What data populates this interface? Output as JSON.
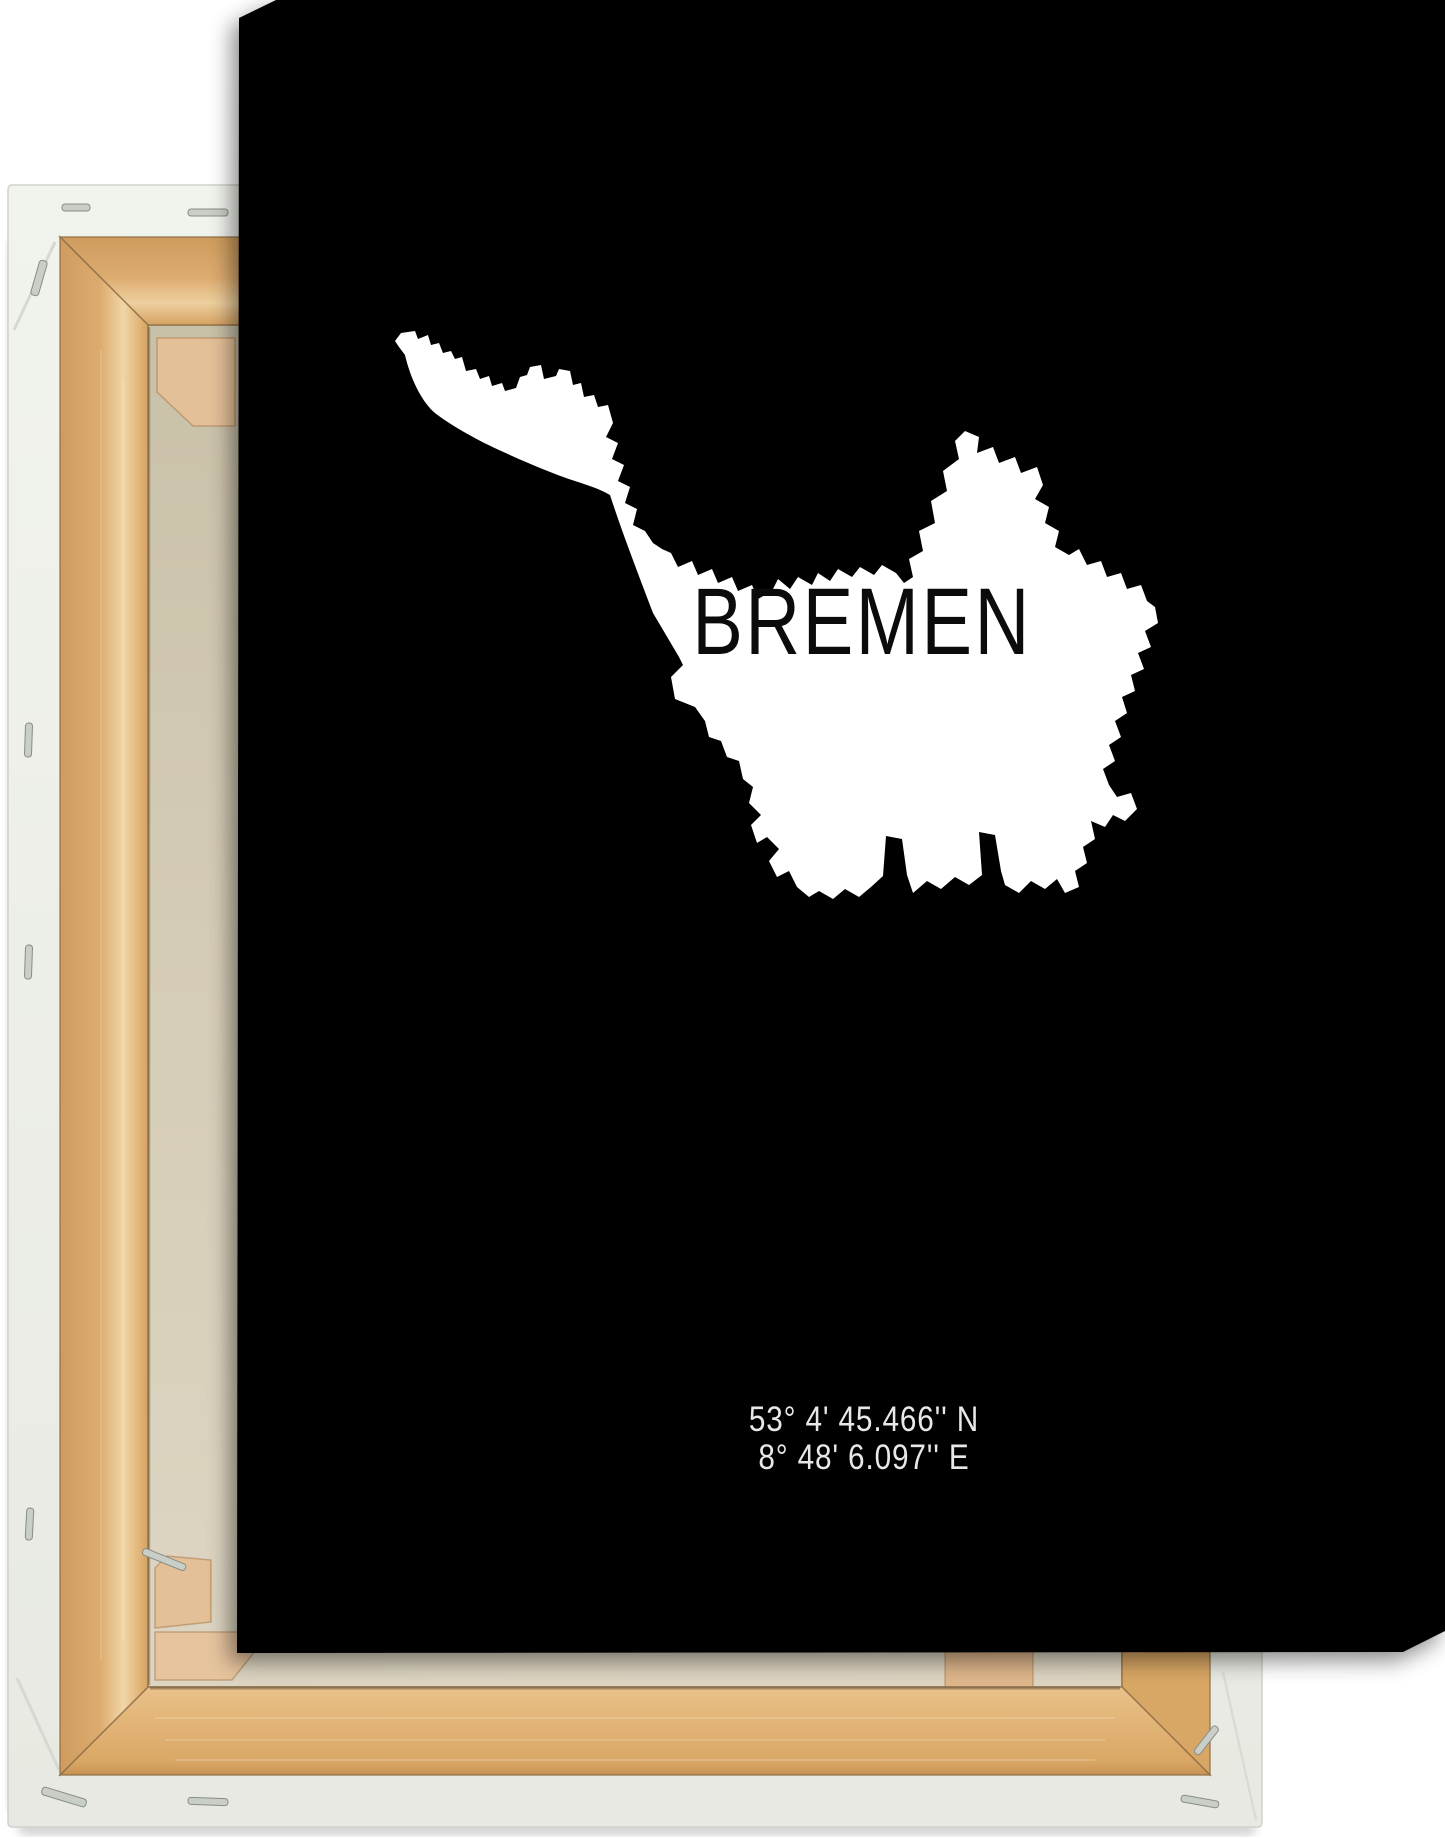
{
  "poster": {
    "title": "BREMEN",
    "coordinates": {
      "line1": "53° 4' 45.466'' N",
      "line2": "8° 48' 6.097'' E"
    },
    "colors": {
      "background": "#000000",
      "map_fill": "#ffffff",
      "title": "#0b0b0b",
      "coordinates": "#e8e8e8"
    },
    "map_path": "M 30 14 L 36 6 L 50 4 L 53 12 L 63 8 L 66 18 L 74 16 L 78 26 L 86 24 L 90 32 L 97 30 L 101 44 L 111 42 L 115 52 L 124 49 L 127 59 L 137 56 L 140 64 L 151 61 L 155 50 L 162 48 L 165 40 L 176 38 L 179 52 L 191 49 L 194 42 L 205 44 L 208 58 L 216 56 L 219 70 L 229 68 L 233 80 L 243 78 L 248 96 L 241 110 L 253 116 L 247 132 L 259 138 L 253 154 L 265 160 L 260 176 L 272 182 L 268 198 L 280 204 L 288 216 L 297 222 L 306 226 L 313 240 L 327 234 L 333 248 L 347 242 L 353 256 L 367 250 L 373 264 L 387 258 L 393 272 L 407 264 L 413 252 L 425 262 L 433 250 L 447 258 L 453 246 L 465 254 L 473 242 L 487 250 L 495 240 L 509 248 L 517 238 L 531 246 L 539 256 L 548 250 L 544 232 L 558 224 L 554 204 L 570 196 L 566 174 L 582 164 L 578 144 L 594 132 L 590 114 L 600 104 L 614 110 L 612 126 L 628 120 L 634 136 L 650 130 L 656 146 L 672 140 L 678 158 L 670 172 L 684 180 L 680 196 L 694 204 L 690 220 L 704 228 L 714 222 L 722 238 L 736 234 L 742 250 L 756 246 L 762 262 L 776 258 L 782 274 L 790 280 L 793 296 L 780 304 L 786 320 L 773 326 L 779 342 L 766 348 L 770 364 L 757 370 L 762 386 L 750 394 L 756 410 L 744 418 L 750 434 L 738 442 L 744 458 L 752 470 L 766 466 L 772 482 L 760 494 L 748 488 L 740 500 L 726 494 L 730 512 L 718 520 L 722 536 L 710 544 L 714 560 L 700 566 L 692 552 L 680 562 L 666 554 L 654 566 L 640 558 L 636 544 L 630 508 L 614 505 L 617 548 L 604 558 L 590 550 L 576 562 L 562 554 L 548 566 L 542 548 L 537 512 L 521 509 L 518 549 L 506 560 L 494 570 L 480 562 L 468 572 L 454 564 L 444 570 L 432 560 L 424 544 L 412 550 L 404 534 L 414 522 L 402 510 L 392 516 L 386 498 L 396 488 L 384 476 L 388 460 L 378 452 L 374 434 L 362 430 L 356 414 L 344 410 L 340 394 L 330 380 L 310 372 L 306 350 L 318 338 L 314 330 L 288 286 C 272 244 256 202 245 168 C 235 162 222 158 213 155 C 188 147 160 135 134 123 C 108 111 84 97 70 86 C 58 76 46 54 40 28 L 34 20 Z"
  },
  "canvas_back": {
    "colors": {
      "wrapped_edge": "#eef0ea",
      "wood": "#dcab6e",
      "wood_highlight": "#f0d6a6",
      "wood_dark": "#8a6a42",
      "raw_canvas": "#d6cdb7",
      "corner_key": "#e3c097",
      "brace_wood": "#dfb68c",
      "staple": "#c9cfc7"
    }
  }
}
